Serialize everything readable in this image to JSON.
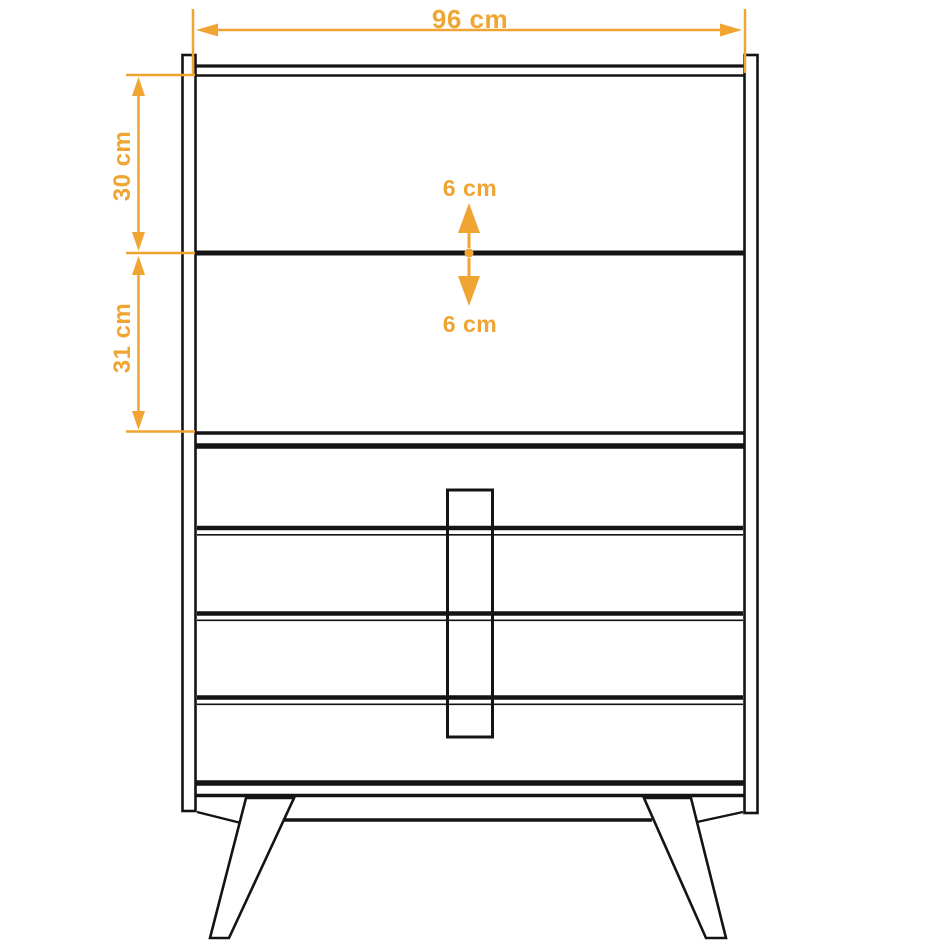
{
  "colors": {
    "annotation_orange": "#F0A432",
    "line_black": "#141414",
    "background": "#FFFFFF"
  },
  "labels": {
    "overall_width": "96 cm",
    "upper_section_height": "30 cm",
    "lower_section_height": "31 cm",
    "clearance_above": "6 cm",
    "clearance_below": "6 cm"
  }
}
